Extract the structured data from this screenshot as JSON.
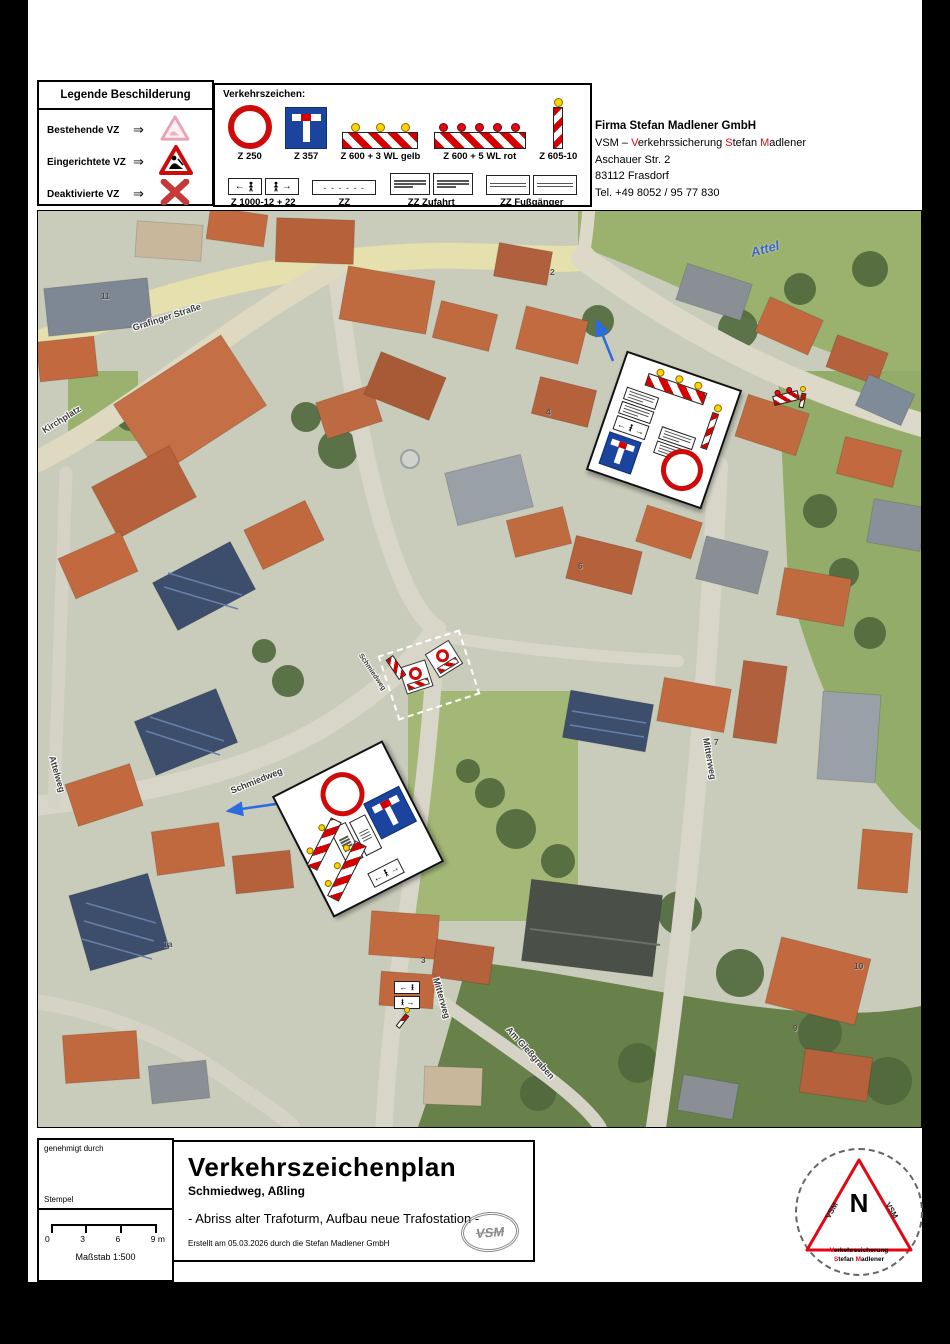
{
  "colors": {
    "sign_red": "#cc0000",
    "sign_blue": "#1b449e",
    "lamp_yellow": "#ffd200",
    "lamp_red": "#e30613",
    "red_text": "#e30613",
    "map_label": "#3b3b3b",
    "river_blue": "#3b62c8",
    "arrow_blue": "#2a6be0"
  },
  "legend": {
    "title": "Legende Beschilderung",
    "items": [
      {
        "label": "Bestehende VZ",
        "arrow": "⇒",
        "icon": "warning-triangle-faded"
      },
      {
        "label": "Eingerichtete VZ",
        "arrow": "⇒",
        "icon": "construction-triangle"
      },
      {
        "label": "Deaktivierte VZ",
        "arrow": "⇒",
        "icon": "red-x"
      }
    ]
  },
  "signs_panel": {
    "title": "Verkehrszeichen:",
    "row1": [
      {
        "code": "Z 250",
        "icon": "no-vehicles-ring"
      },
      {
        "code": "Z 357",
        "icon": "dead-end-sign"
      },
      {
        "code": "Z 600 + 3 WL gelb",
        "icon": "barrier-3-warning-lights-yellow"
      },
      {
        "code": "Z 600 + 5 WL rot",
        "icon": "barrier-5-warning-lights-red"
      },
      {
        "code": "Z 605-10",
        "icon": "striped-guide-post"
      }
    ],
    "row2": [
      {
        "code": "Z 1000-12 + 22",
        "icon": "pedestrian-direction-plates"
      },
      {
        "code": "ZZ",
        "icon": "blank-plate"
      },
      {
        "code": "ZZ Zufahrt",
        "icon": "access-text-plates"
      },
      {
        "code": "ZZ Fußgänger",
        "icon": "pedestrian-text-plates"
      }
    ]
  },
  "company": {
    "name": "Firma Stefan Madlener GmbH",
    "line2": [
      {
        "t": "VSM – "
      },
      {
        "t": "V",
        "red": true
      },
      {
        "t": "erkehrssicherung "
      },
      {
        "t": "S",
        "red": true
      },
      {
        "t": "tefan  "
      },
      {
        "t": "M",
        "red": true
      },
      {
        "t": "adlener"
      }
    ],
    "street": "Aschauer Str. 2",
    "city": "83112 Frasdorf",
    "phone": "Tel. +49 8052 / 95 77 830"
  },
  "map": {
    "river_label": "Attel",
    "labels": [
      {
        "text": "Grafinger Straße"
      },
      {
        "text": "Kirchplatz"
      },
      {
        "text": "Attelweg"
      },
      {
        "text": "Schmiedweg"
      },
      {
        "text": "Schmiedweg"
      },
      {
        "text": "Mitterweg"
      },
      {
        "text": "Mitterweg"
      },
      {
        "text": "Am Gießgraben"
      }
    ],
    "houses": [
      "11",
      "2",
      "4",
      "6",
      "7",
      "1a",
      "3",
      "10",
      "9"
    ]
  },
  "footer": {
    "approved_label": "genehmigt durch",
    "stamp_label": "Stempel",
    "scale_ticks": [
      "0",
      "3",
      "6",
      "9 m"
    ],
    "scale_label": "Maßstab 1:500",
    "title": "Verkehrszeichenplan",
    "subtitle": "Schmiedweg, Aßling",
    "description": "- Abriss alter Trafoturm, Aufbau neue Trafostation -",
    "created": "Erstellt am 05.03.2026 durch die Stefan Madlener GmbH",
    "logo_text": "VSM"
  },
  "compass": {
    "north": "N",
    "left_text": "VSM",
    "right_text": "VSM",
    "line1": [
      {
        "t": "V",
        "red": true
      },
      {
        "t": "erkehrssicherung"
      }
    ],
    "line2": [
      {
        "t": "S",
        "red": true
      },
      {
        "t": "tefan "
      },
      {
        "t": "M",
        "red": true
      },
      {
        "t": "adlener"
      }
    ]
  }
}
